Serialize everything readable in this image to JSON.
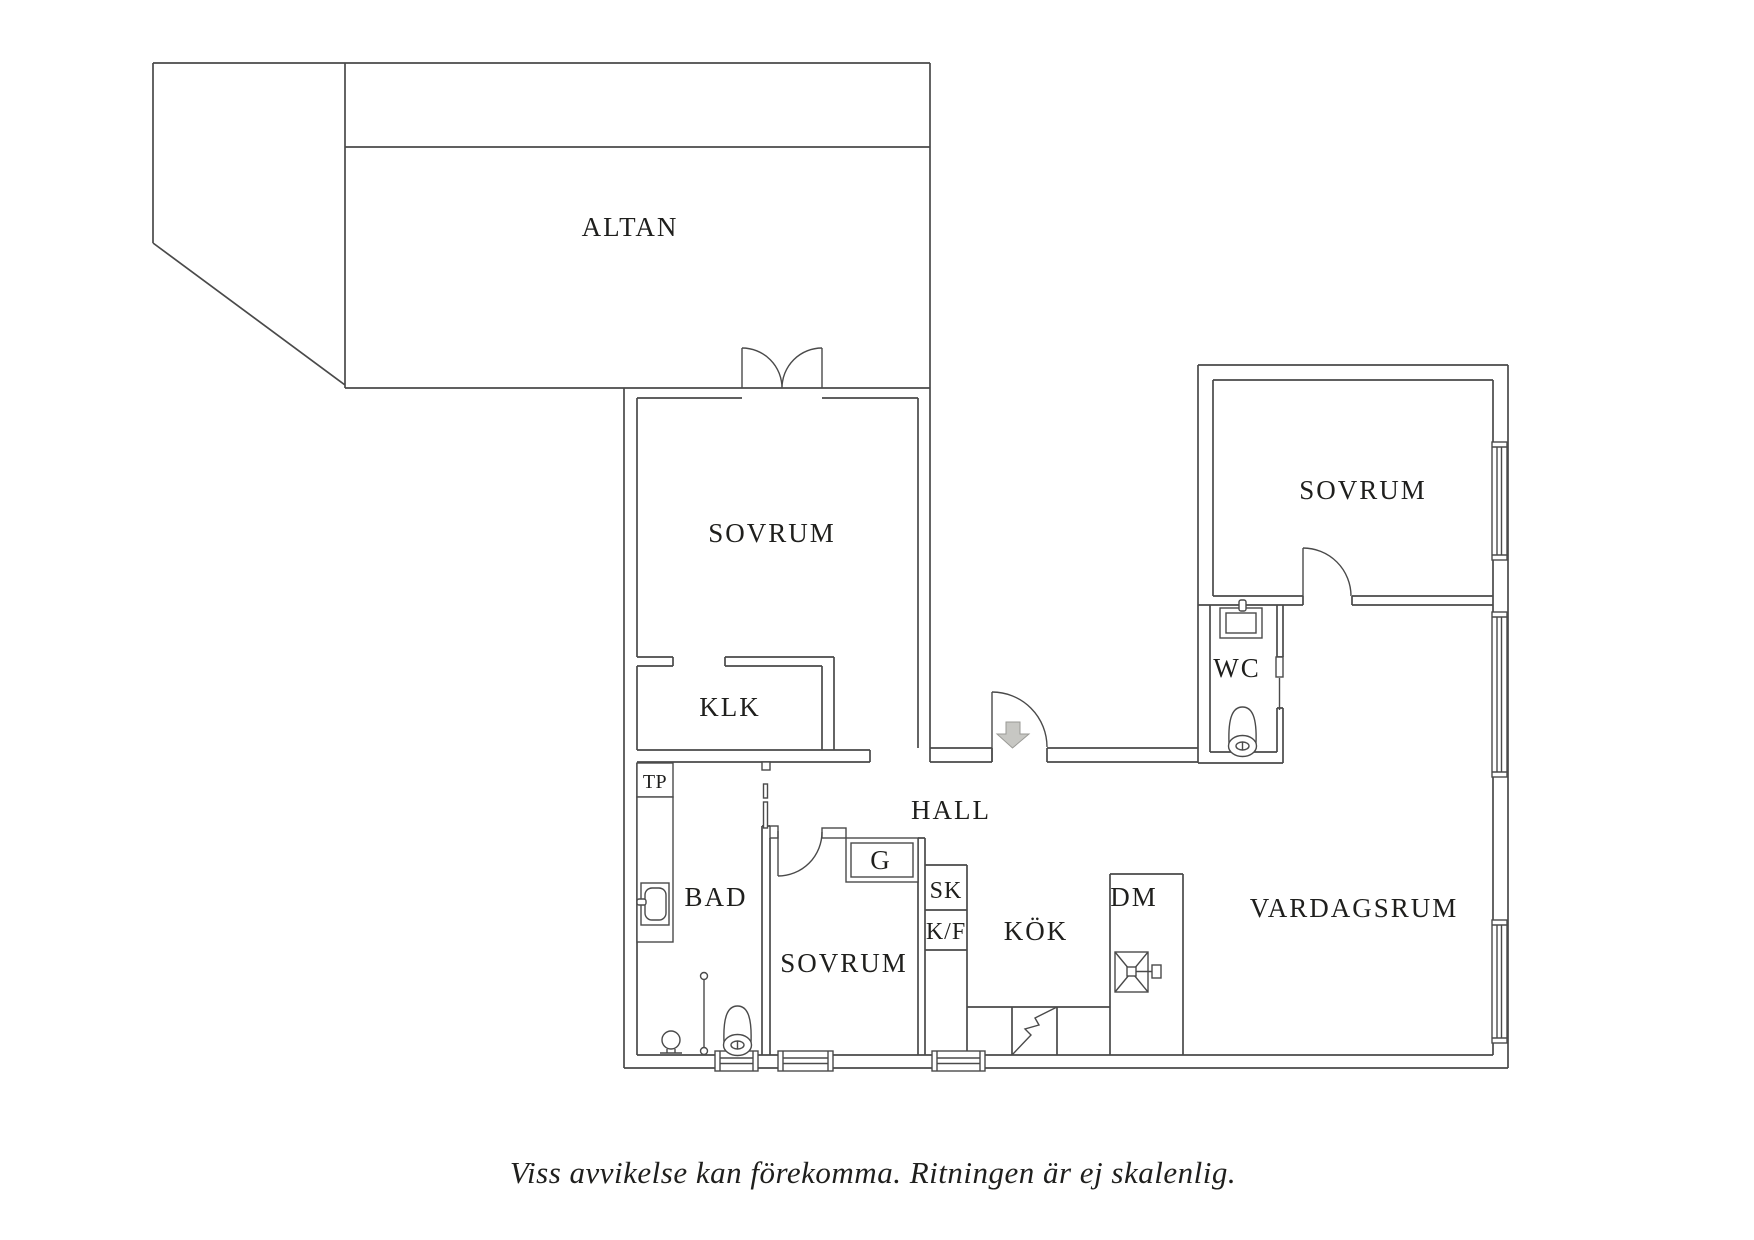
{
  "floorplan": {
    "rooms": {
      "altan": {
        "label": "ALTAN"
      },
      "sovrum_left": {
        "label": "SOVRUM"
      },
      "klk": {
        "label": "KLK"
      },
      "tp": {
        "label": "TP"
      },
      "bad": {
        "label": "BAD"
      },
      "sovrum_mid": {
        "label": "SOVRUM"
      },
      "g": {
        "label": "G"
      },
      "sk": {
        "label": "SK"
      },
      "kf": {
        "label": "K/F"
      },
      "hall": {
        "label": "HALL"
      },
      "kok": {
        "label": "KÖK"
      },
      "dm": {
        "label": "DM"
      },
      "wc": {
        "label": "WC"
      },
      "sovrum_right": {
        "label": "SOVRUM"
      },
      "vardagsrum": {
        "label": "VARDAGSRUM"
      }
    },
    "caption": "Viss avvikelse kan förekomma. Ritningen är ej skalenlig.",
    "colors": {
      "background": "#ffffff",
      "wall": "#4a4a4a",
      "text": "#1f1f1d",
      "arrow_fill": "#c7c7c3",
      "arrow_stroke": "#9a9a96"
    }
  }
}
